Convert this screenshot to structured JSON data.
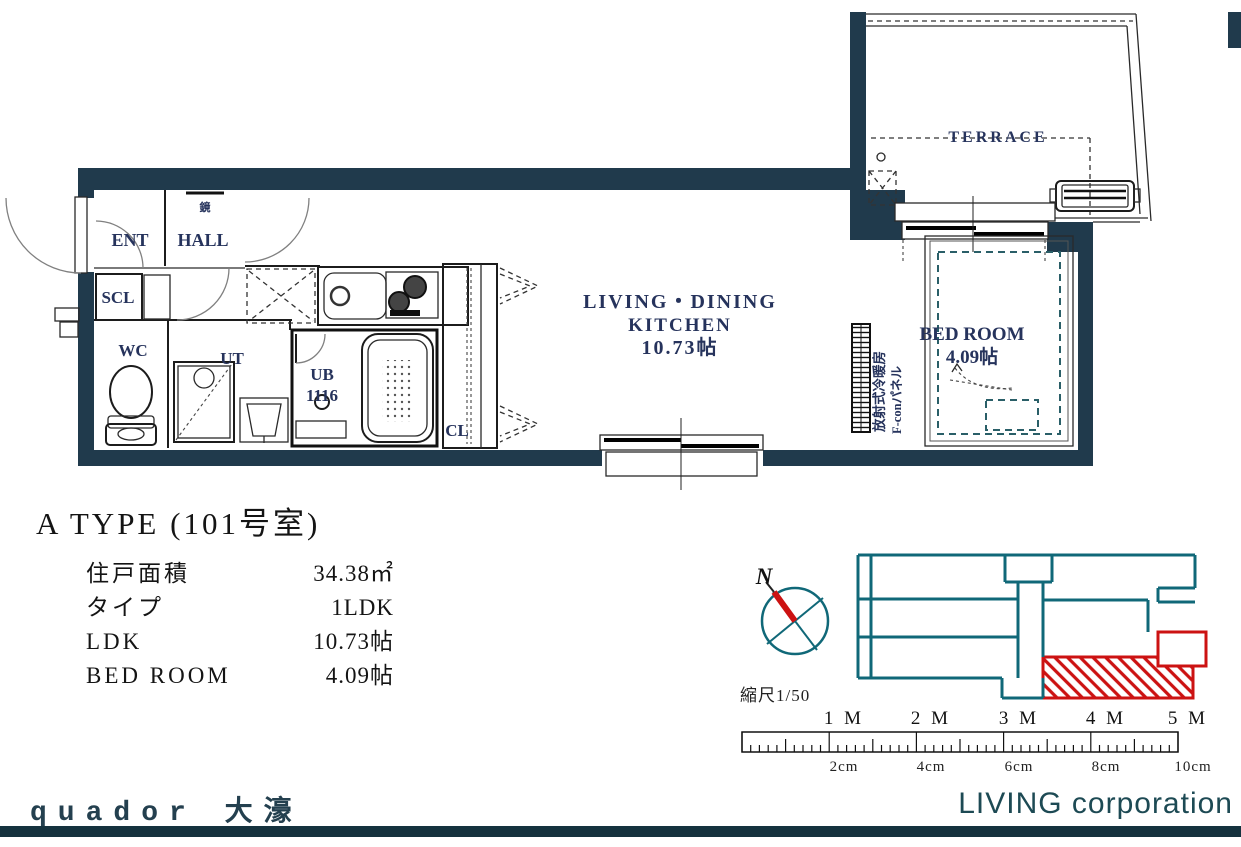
{
  "plan": {
    "labels": {
      "ent": "ENT",
      "hall": "HALL",
      "scl": "SCL",
      "wc": "WC",
      "ut": "UT",
      "ub": "UB",
      "ub_size": "1116",
      "cl": "CL",
      "mirror": "鏡",
      "ldk1": "LIVING・DINING",
      "ldk2": "KITCHEN",
      "ldk3": "10.73帖",
      "bedroom1": "BED ROOM",
      "bedroom2": "4.09帖",
      "terrace": "TERRACE",
      "heater1": "放射式冷暖房",
      "heater2": "F-conパネル"
    }
  },
  "info": {
    "title": "A TYPE (101号室)",
    "rows": [
      {
        "label": "住戸面積",
        "value": "34.38㎡"
      },
      {
        "label": "タイプ",
        "value": "1LDK"
      },
      {
        "label": "LDK",
        "value": "10.73帖"
      },
      {
        "label": "BED ROOM",
        "value": "4.09帖"
      }
    ]
  },
  "compass": {
    "north": "N",
    "scale_caption": "縮尺1/50"
  },
  "ruler": {
    "meter_labels": [
      "1 M",
      "2 M",
      "3 M",
      "4 M",
      "5 M"
    ],
    "cm_labels": [
      "2cm",
      "4cm",
      "6cm",
      "8cm",
      "10cm"
    ]
  },
  "footer": {
    "project": "quador 大濠",
    "company": "LIVING corporation"
  },
  "colors": {
    "wall_navy": "#203a4c",
    "map_teal": "#106878",
    "highlight_red": "#cc1212",
    "label_blue": "#26335c",
    "bed_teal": "#2a5f68",
    "footer_bar": "#15323e"
  }
}
